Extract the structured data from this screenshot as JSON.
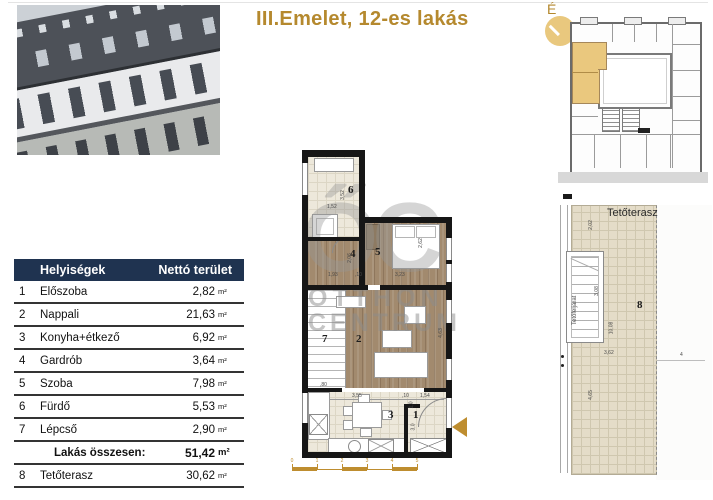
{
  "title": "III.Emelet, 12-es lakás",
  "compass": {
    "label": "É"
  },
  "colors": {
    "accent_gold": "#B5892E",
    "header_navy": "#1F3350",
    "unit_highlight": "#EAC87E"
  },
  "table": {
    "col_room": "Helyiségek",
    "col_area": "Nettó terület",
    "rows": [
      {
        "num": "1",
        "name": "Előszoba",
        "value": "2,82",
        "unit": "m²"
      },
      {
        "num": "2",
        "name": "Nappali",
        "value": "21,63",
        "unit": "m²"
      },
      {
        "num": "3",
        "name": "Konyha+étkező",
        "value": "6,92",
        "unit": "m²"
      },
      {
        "num": "4",
        "name": "Gardrób",
        "value": "3,64",
        "unit": "m²"
      },
      {
        "num": "5",
        "name": "Szoba",
        "value": "7,98",
        "unit": "m²"
      },
      {
        "num": "6",
        "name": "Fürdő",
        "value": "5,53",
        "unit": "m²"
      },
      {
        "num": "7",
        "name": "Lépcső",
        "value": "2,90",
        "unit": "m²"
      }
    ],
    "total": {
      "label": "Lakás összesen:",
      "value": "51,42",
      "unit": "m²"
    },
    "terrace_row": {
      "num": "8",
      "name": "Tetőterasz",
      "value": "30,62",
      "unit": "m²"
    }
  },
  "plan": {
    "room_numbers": {
      "r1": "1",
      "r2": "2",
      "r3": "3",
      "r4": "4",
      "r5": "5",
      "r6": "6",
      "r7": "7"
    },
    "dims": {
      "v352": "3,52",
      "h152": "1,52",
      "v206": "2,06",
      "h193": "1,93",
      "h10a": ",10",
      "h323": "3,23",
      "v262": "2,62",
      "v463": "4,63",
      "h80": ",80",
      "h355": "3,55",
      "h10b": ",10",
      "h154": "1,54",
      "v10": "1,0",
      "v30": "3,0"
    },
    "scale_ticks": [
      "0",
      "1",
      "2",
      "3",
      "4",
      "5"
    ],
    "watermark": {
      "logo": "ŐC",
      "line1": "OTTHON",
      "line2": "CENTRUM"
    }
  },
  "terrace": {
    "title": "Tetőterasz",
    "room_number": "8",
    "access_label": "Tetőfeljárat",
    "dims": {
      "v202": "2,02",
      "v308": "3,08",
      "v1008": "10,08",
      "h362": "3,62",
      "v465": "4,65",
      "h4": "4"
    }
  }
}
